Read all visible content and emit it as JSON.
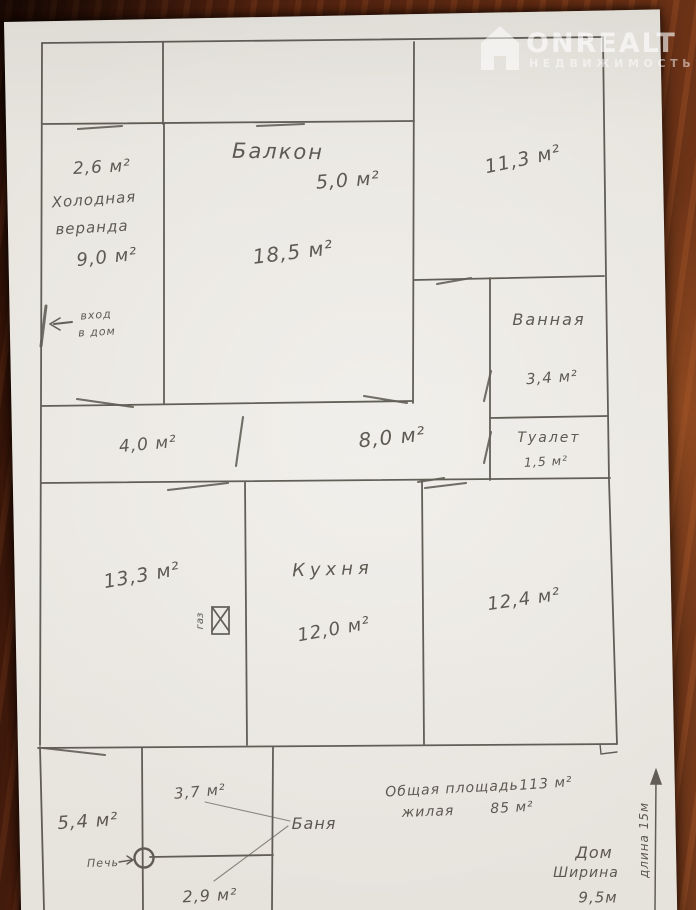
{
  "watermark": {
    "brand": "ONREALT",
    "subtitle": "НЕДВИЖИМОСТЬ"
  },
  "plan": {
    "rooms": {
      "storage": {
        "area": "2,6 м²"
      },
      "balcony": {
        "name": "Балкон",
        "area": "5,0 м²"
      },
      "room_11_3": {
        "area": "11,3 м²"
      },
      "veranda": {
        "name_line1": "Холодная",
        "name_line2": "веранда",
        "area": "9,0 м²"
      },
      "room_18_5": {
        "area": "18,5 м²"
      },
      "bathroom": {
        "name": "Ванная",
        "area": "3,4 м²"
      },
      "toilet": {
        "name": "Туалет",
        "area": "1,5 м²"
      },
      "hall_left": {
        "area": "4,0 м²"
      },
      "hall_right": {
        "area": "8,0 м²"
      },
      "room_13_3": {
        "area": "13,3 м²"
      },
      "kitchen": {
        "name": "Кухня",
        "area": "12,0 м²"
      },
      "room_12_4": {
        "area": "12,4 м²"
      },
      "room_5_4": {
        "area": "5,4 м²"
      },
      "banya": {
        "name": "Баня",
        "top_area": "3,7 м²",
        "bottom_area": "2,9 м²"
      }
    },
    "annotations": {
      "entrance_line1": "вход",
      "entrance_line2": "в дом",
      "stove": "Печь",
      "gas": "газ",
      "total_label": "Общая площадь",
      "total_value": "113 м²",
      "living_label": "жилая",
      "living_value": "85 м²",
      "house_line1": "Дом",
      "house_line2": "Ширина",
      "house_line3": "9,5м",
      "length_vertical": "длина   15м"
    }
  },
  "colors": {
    "pencil": "#4a463f",
    "paper": "#e8e5df",
    "wood": "#5e2a13"
  }
}
